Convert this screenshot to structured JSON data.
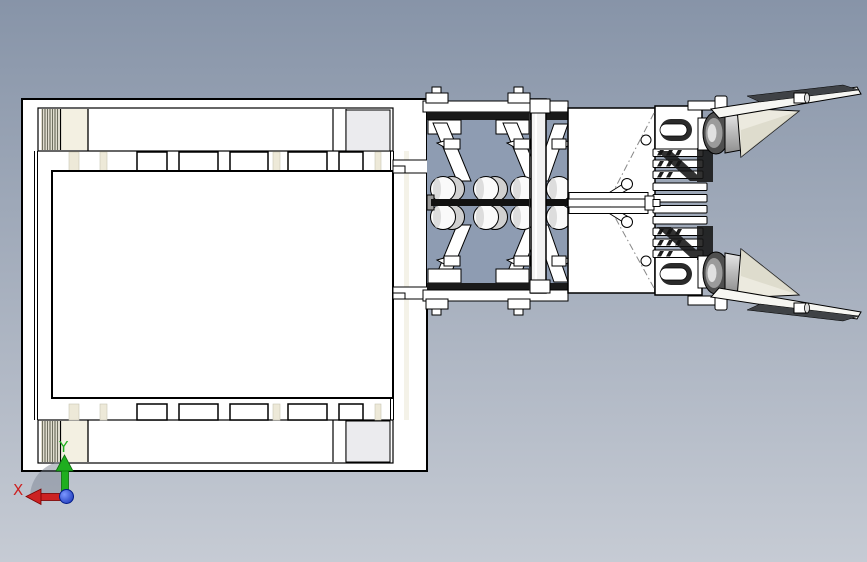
{
  "viewport": {
    "colors": {
      "bg_top": "#8794a8",
      "bg_bottom": "#c6cbd4",
      "model_fill": "#ffffff",
      "outline": "#000000",
      "interior": "#8e9cb2",
      "cream": "#ece8d8",
      "panel_gray": "#ebebee",
      "dark_shadow": "#1a1a1a",
      "metal_dark": "#4f4f4f",
      "metal_mid": "#9b9b9b",
      "blade_dark": "#3f4246",
      "cone_cream": "#eceadf"
    }
  },
  "triad": {
    "x_axis": {
      "label": "X",
      "color": "#cc2222"
    },
    "y_axis": {
      "label": "Y",
      "color": "#1fae1f"
    },
    "origin_color": "#1d3fd4"
  }
}
